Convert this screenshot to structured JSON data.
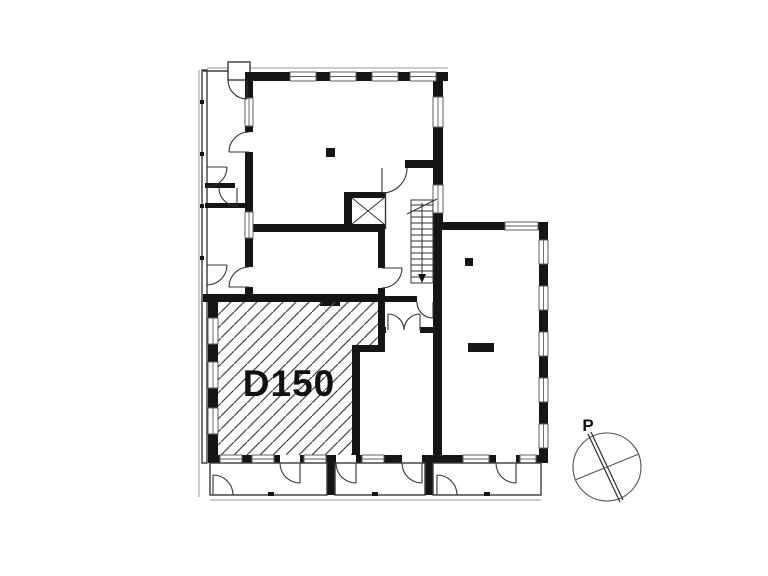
{
  "canvas": {
    "width": 768,
    "height": 576,
    "background": "#ffffff"
  },
  "floor_plan": {
    "room_label": "D150",
    "compass": {
      "label": "P"
    },
    "colors": {
      "wall": "#151515",
      "line": "#333333",
      "window_frame": "#606060",
      "hatch": "#4a4a4a"
    }
  }
}
